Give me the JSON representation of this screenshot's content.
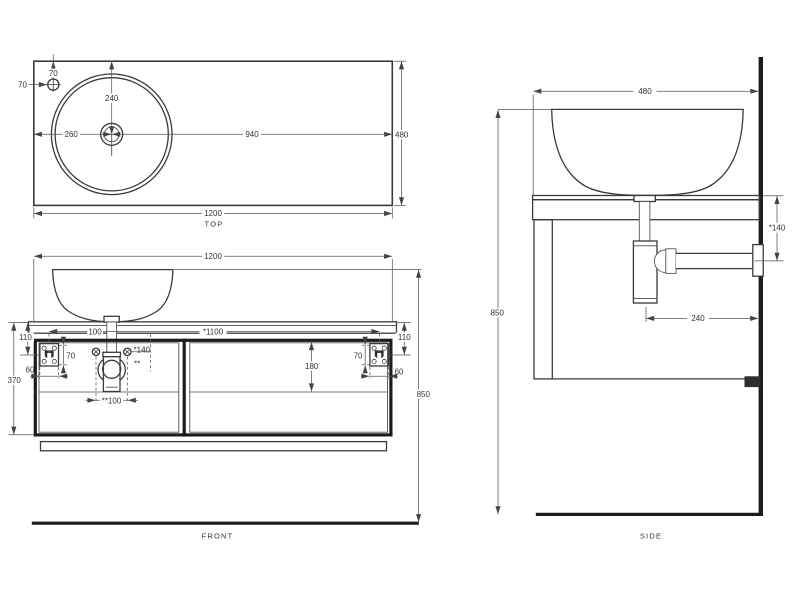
{
  "colors": {
    "ink": "#333333",
    "ink_strong": "#1c1c1c",
    "background": "#ffffff"
  },
  "views": {
    "top": {
      "label": "TOP",
      "dim_width": "1200",
      "dim_depth": "480",
      "dim_basin_center_from_top": "240",
      "dim_basin_center_from_left": "260",
      "dim_basin_center_to_right": "940",
      "dim_faucet_from_left": "70",
      "dim_faucet_from_top": "70"
    },
    "front": {
      "label": "FRONT",
      "dim_width": "1200",
      "dim_height": "850",
      "dim_top_to_bracket": "110",
      "dim_top_to_cabinet_bottom": "370",
      "dim_bracket_width": "60",
      "dim_bracket_height": "70",
      "dim_bracket_spacing": "*1100",
      "dim_trap_offset": "100",
      "dim_screw_offset": "*140",
      "screw_note": "**",
      "dim_screw_spacing": "**100",
      "dim_drawer_height": "180"
    },
    "side": {
      "label": "SIDE",
      "dim_depth": "480",
      "dim_height": "850",
      "dim_counter_to_outlet": "*140",
      "dim_trap_to_wall": "240"
    }
  }
}
